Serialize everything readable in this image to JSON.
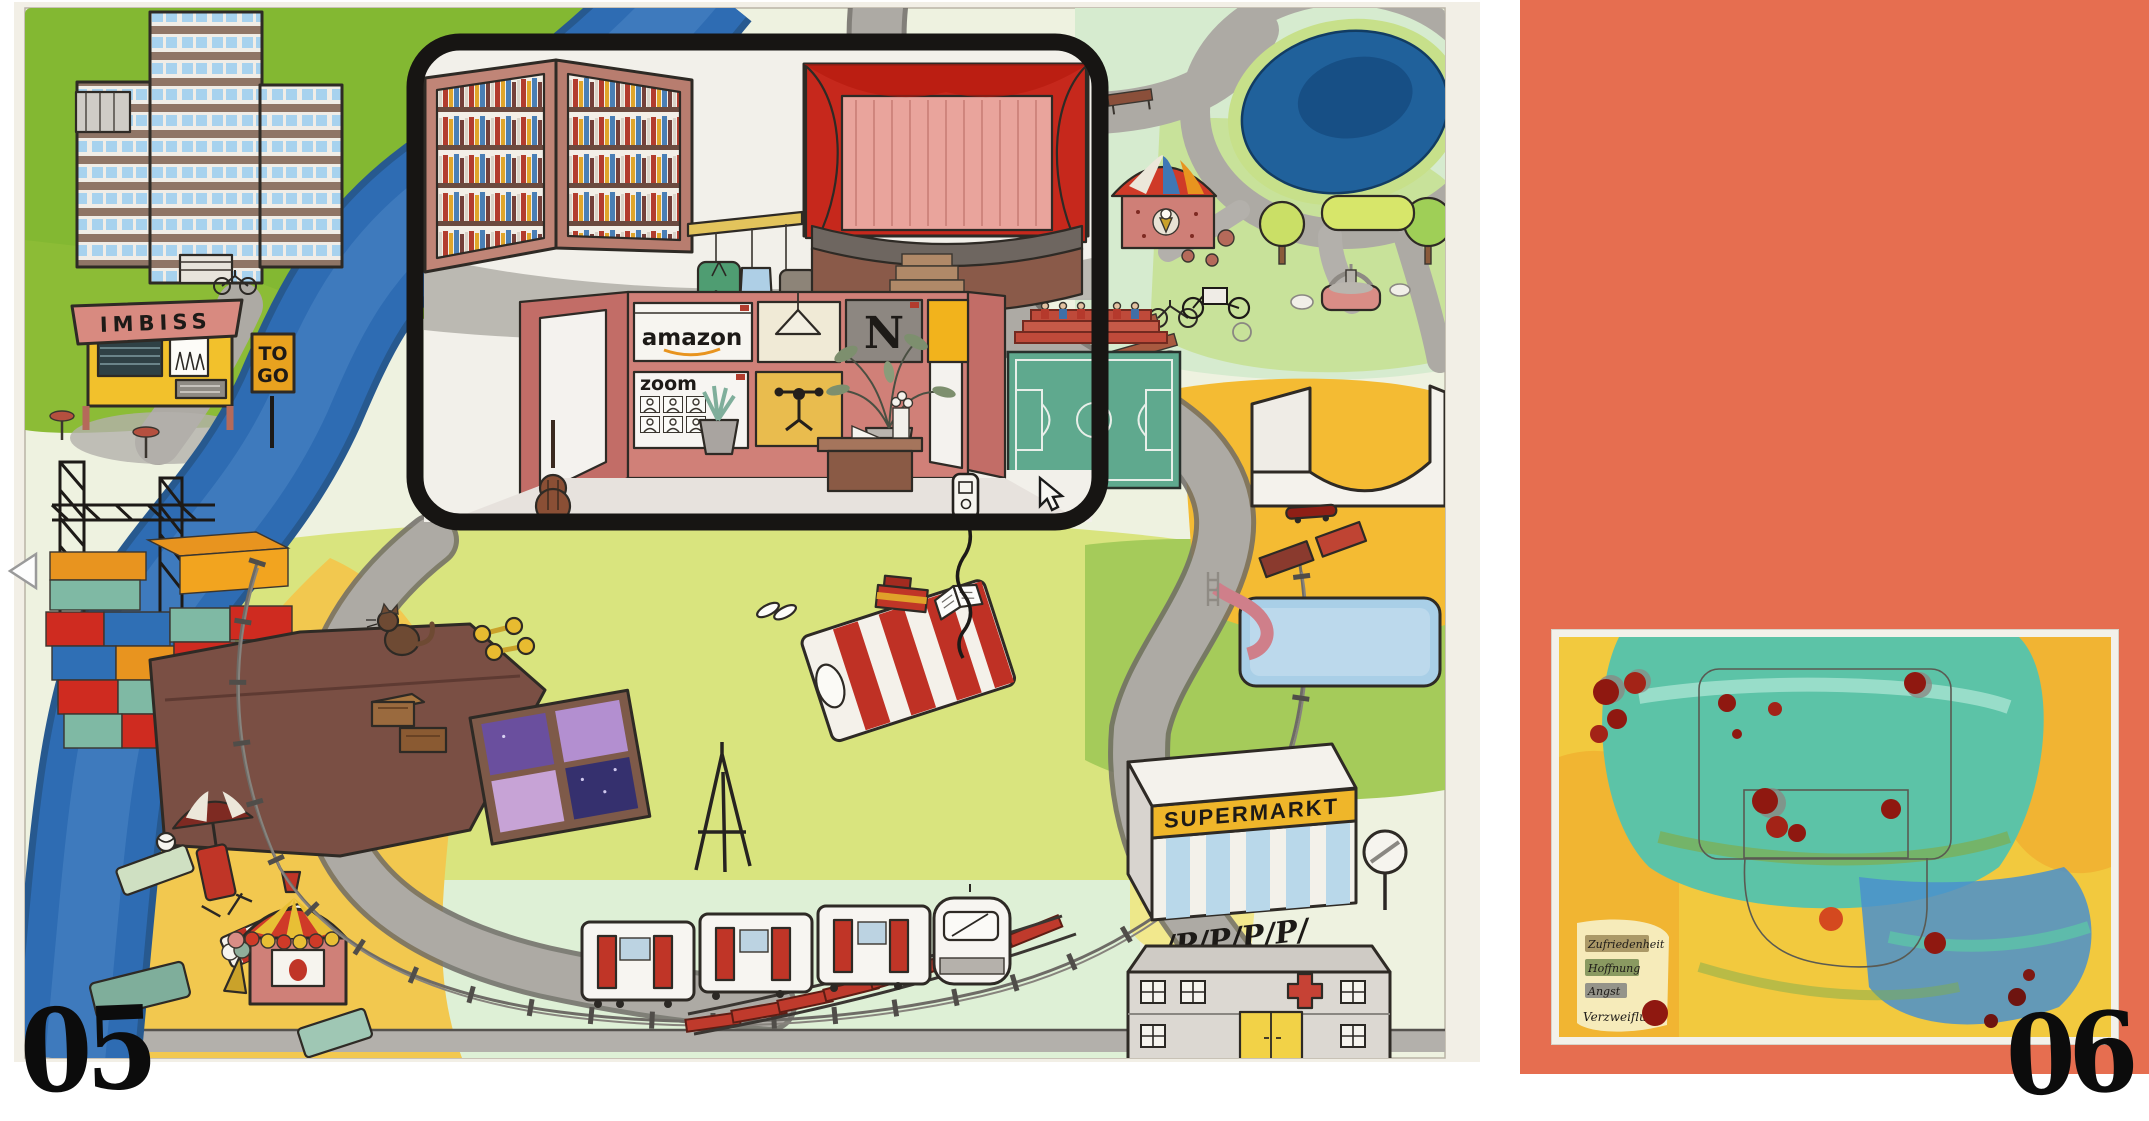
{
  "window": {
    "width": 2149,
    "height": 1074,
    "background": "#ffffff"
  },
  "navigation": {
    "previous_label": "previous page"
  },
  "left_page": {
    "page_number": "05",
    "signs": {
      "imbiss": "IMBISS",
      "togo_line1": "TO",
      "togo_line2": "GO",
      "supermarkt": "SUPERMARKT",
      "parking": "/P/P/P/P/"
    },
    "screens": {
      "amazon": "amazon",
      "netflix": "N",
      "stine": "STiNE",
      "zoom": "zoom"
    }
  },
  "right_page": {
    "page_number": "06",
    "background_color": "#e66e50",
    "legend": {
      "items": [
        {
          "label": "Zufriedenheit",
          "swatch": "#a3905e"
        },
        {
          "label": "Hoffnung",
          "swatch": "#7e9158"
        },
        {
          "label": "Angst",
          "swatch": "#8b8b85"
        },
        {
          "label": "Verzweiflung",
          "swatch": "#8f1810"
        }
      ]
    }
  },
  "palette": {
    "salmon": "#e66e50",
    "river_blue": "#2e6cb3",
    "pond_blue": "#20619b",
    "grass_green": "#83b832",
    "beach_yellow": "#f2c84f",
    "frame_black": "#171513",
    "theater_red": "#c6281c",
    "stine_yellow": "#f2b31c",
    "netflix_red": "#b5251c"
  }
}
